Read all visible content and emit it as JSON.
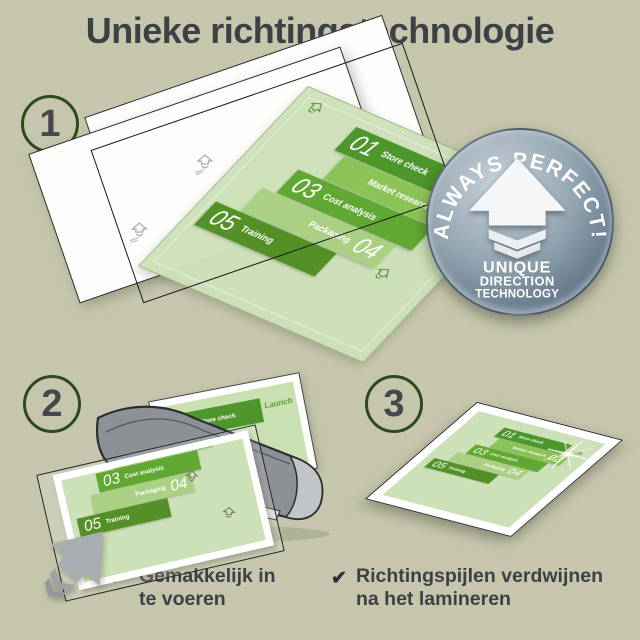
{
  "title": "Unieke richtingstechnologie",
  "steps": [
    {
      "number": "1"
    },
    {
      "number": "2"
    },
    {
      "number": "3"
    }
  ],
  "badge": {
    "arc_text": "ALWAYS PERFECT!",
    "line1": "UNIQUE",
    "line2": "DIRECTION",
    "line3": "TECHNOLOGY"
  },
  "infographic": {
    "launch_label": "Launch",
    "items": [
      {
        "num": "01",
        "label": "Store check"
      },
      {
        "num": "02",
        "label": "Market research"
      },
      {
        "num": "03",
        "label": "Cost analysis"
      },
      {
        "num": "04",
        "label": "Packaging"
      },
      {
        "num": "05",
        "label": "Training"
      }
    ]
  },
  "bullets": [
    {
      "check": "✔",
      "line1": "Gemakkelijk in",
      "line2": "te voeren"
    },
    {
      "check": "✔",
      "line1": "Richtingspijlen verdwijnen",
      "line2": "na het lamineren"
    }
  ],
  "colors": {
    "background": "#c5c6ab",
    "title_text": "#3b4145",
    "step_ring_green": "#2c4a1d",
    "step_number_gray": "#45494d",
    "badge_steel_light": "#c7d1d8",
    "badge_steel_dark": "#4d6173",
    "sheet_green_light": "#cfe2ba",
    "block_green_dark": "#4c962b",
    "block_green_medium": "#60a832",
    "block_green_pale": "#aad084",
    "launch_green": "#57a32e",
    "laminator_gray": "#8d9195",
    "arrow_gray": "#aaadaf",
    "bullet_text": "#3b4145"
  }
}
